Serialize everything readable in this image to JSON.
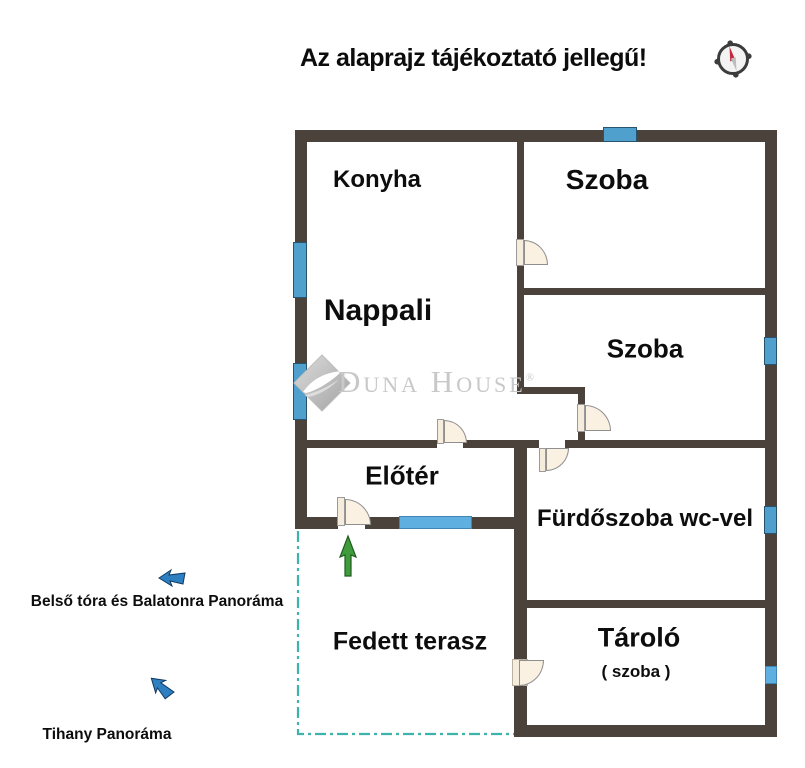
{
  "title": "Az alaprajz tájékoztató jellegű!",
  "watermark": {
    "brand": "Duna House",
    "registered_mark": "®"
  },
  "rooms": {
    "konyha": "Konyha",
    "szoba_felso": "Szoba",
    "nappali": "Nappali",
    "szoba_also": "Szoba",
    "eloter": "Előtér",
    "furdoszoba": "Fürdőszoba wc-vel",
    "fedett_terasz": "Fedett terasz",
    "tarolo": "Tároló",
    "tarolo_sub": "( szoba )"
  },
  "annotations": {
    "balaton": "Belső tóra és Balatonra Panoráma",
    "tihany": "Tihany Panoráma"
  },
  "colors": {
    "wall": "#4a423b",
    "window_blue": "#4fa0cc",
    "window_light_blue": "#5fb0e0",
    "terrace_dash_teal": "#3cb4ab",
    "entry_arrow_green": "#3f9b3c",
    "panorama_arrow_blue": "#2e7fc0",
    "door_fill_cream": "#faf1e2",
    "watermark_gray": "#c8c8c8",
    "compass_needle_red": "#c22b3d"
  }
}
